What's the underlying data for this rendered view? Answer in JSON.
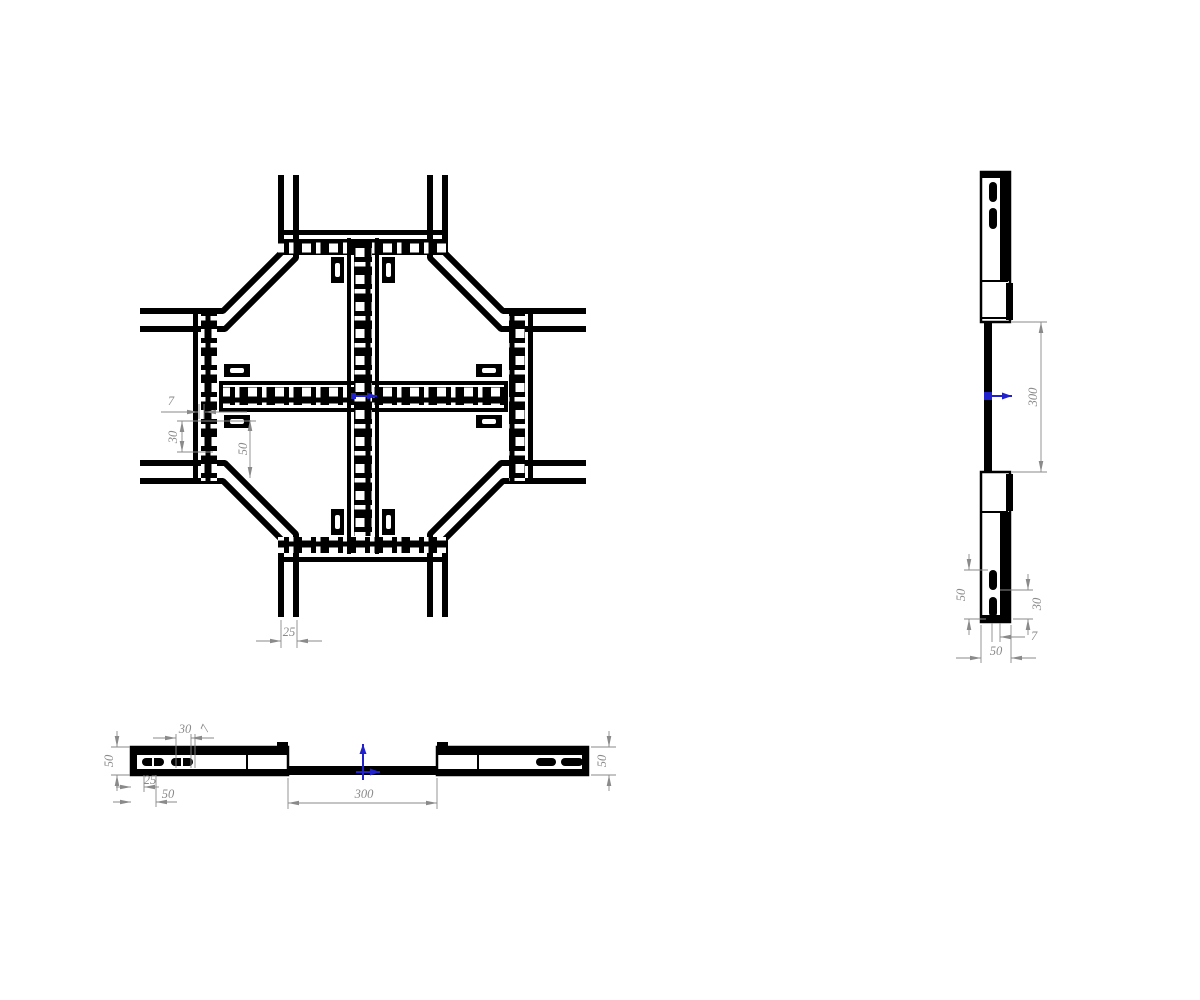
{
  "drawing": {
    "type": "cad-orthographic-views",
    "subject": "cable-tray-cross-junction",
    "background": "#ffffff",
    "colors": {
      "line": "#000000",
      "dimension": "#8a8a8a",
      "accent_arrow": "#2222cc"
    },
    "icons": {
      "origin_marker": "origin-arrow-icon"
    }
  },
  "views": {
    "plan": {
      "name": "plan view (cross junction, top)",
      "dimension_labels": [
        "7",
        "30",
        "50",
        "25"
      ]
    },
    "side": {
      "name": "side elevation (right)",
      "dimension_labels": [
        "300",
        "50",
        "30",
        "7",
        "50"
      ]
    },
    "front": {
      "name": "front elevation (bottom)",
      "dimension_labels": [
        "50",
        "30",
        "7",
        "25",
        "50",
        "300",
        "50"
      ]
    }
  }
}
